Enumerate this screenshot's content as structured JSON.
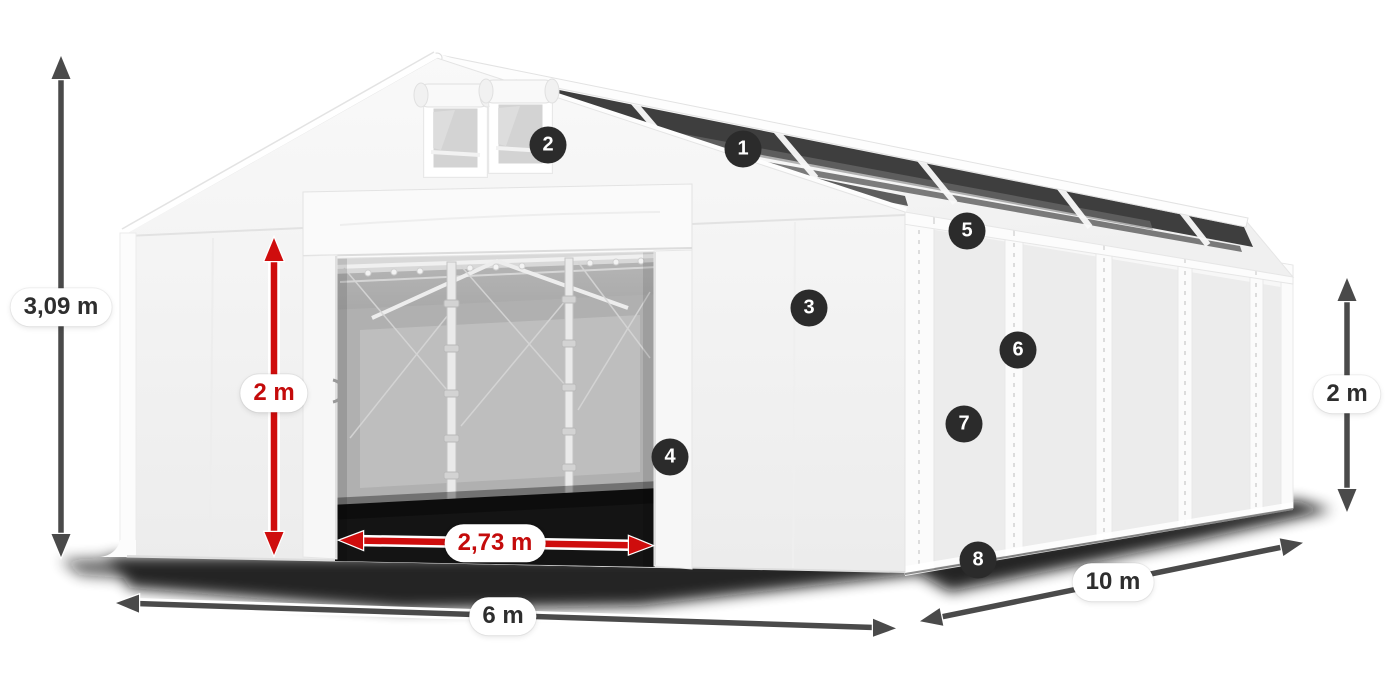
{
  "diagram": {
    "subject": "storage-tent-dimension-diagram"
  },
  "dimensions": {
    "total_height": {
      "label": "3,09 m",
      "color": "#2e2e2e"
    },
    "door_height": {
      "label": "2 m",
      "color": "#c40b0b"
    },
    "door_width": {
      "label": "2,73 m",
      "color": "#c40b0b"
    },
    "front_width": {
      "label": "6 m",
      "color": "#2e2e2e"
    },
    "side_length": {
      "label": "10 m",
      "color": "#2e2e2e"
    },
    "side_height": {
      "label": "2 m",
      "color": "#2e2e2e"
    }
  },
  "markers": [
    {
      "number": "1"
    },
    {
      "number": "2"
    },
    {
      "number": "3"
    },
    {
      "number": "4"
    },
    {
      "number": "5"
    },
    {
      "number": "6"
    },
    {
      "number": "7"
    },
    {
      "number": "8"
    }
  ],
  "colors": {
    "background": "#ffffff",
    "marker_bg": "#2b2b2b",
    "marker_text": "#ffffff",
    "dimension_line": "#4a4a4a",
    "door_dimension_line": "#cf0d0d",
    "label_bg": "#ffffff",
    "label_text": "#2e2e2e",
    "label_text_red": "#c40b0b",
    "tent_fabric": "#f4f4f4",
    "skylight_panel": "#3e3e3e"
  }
}
